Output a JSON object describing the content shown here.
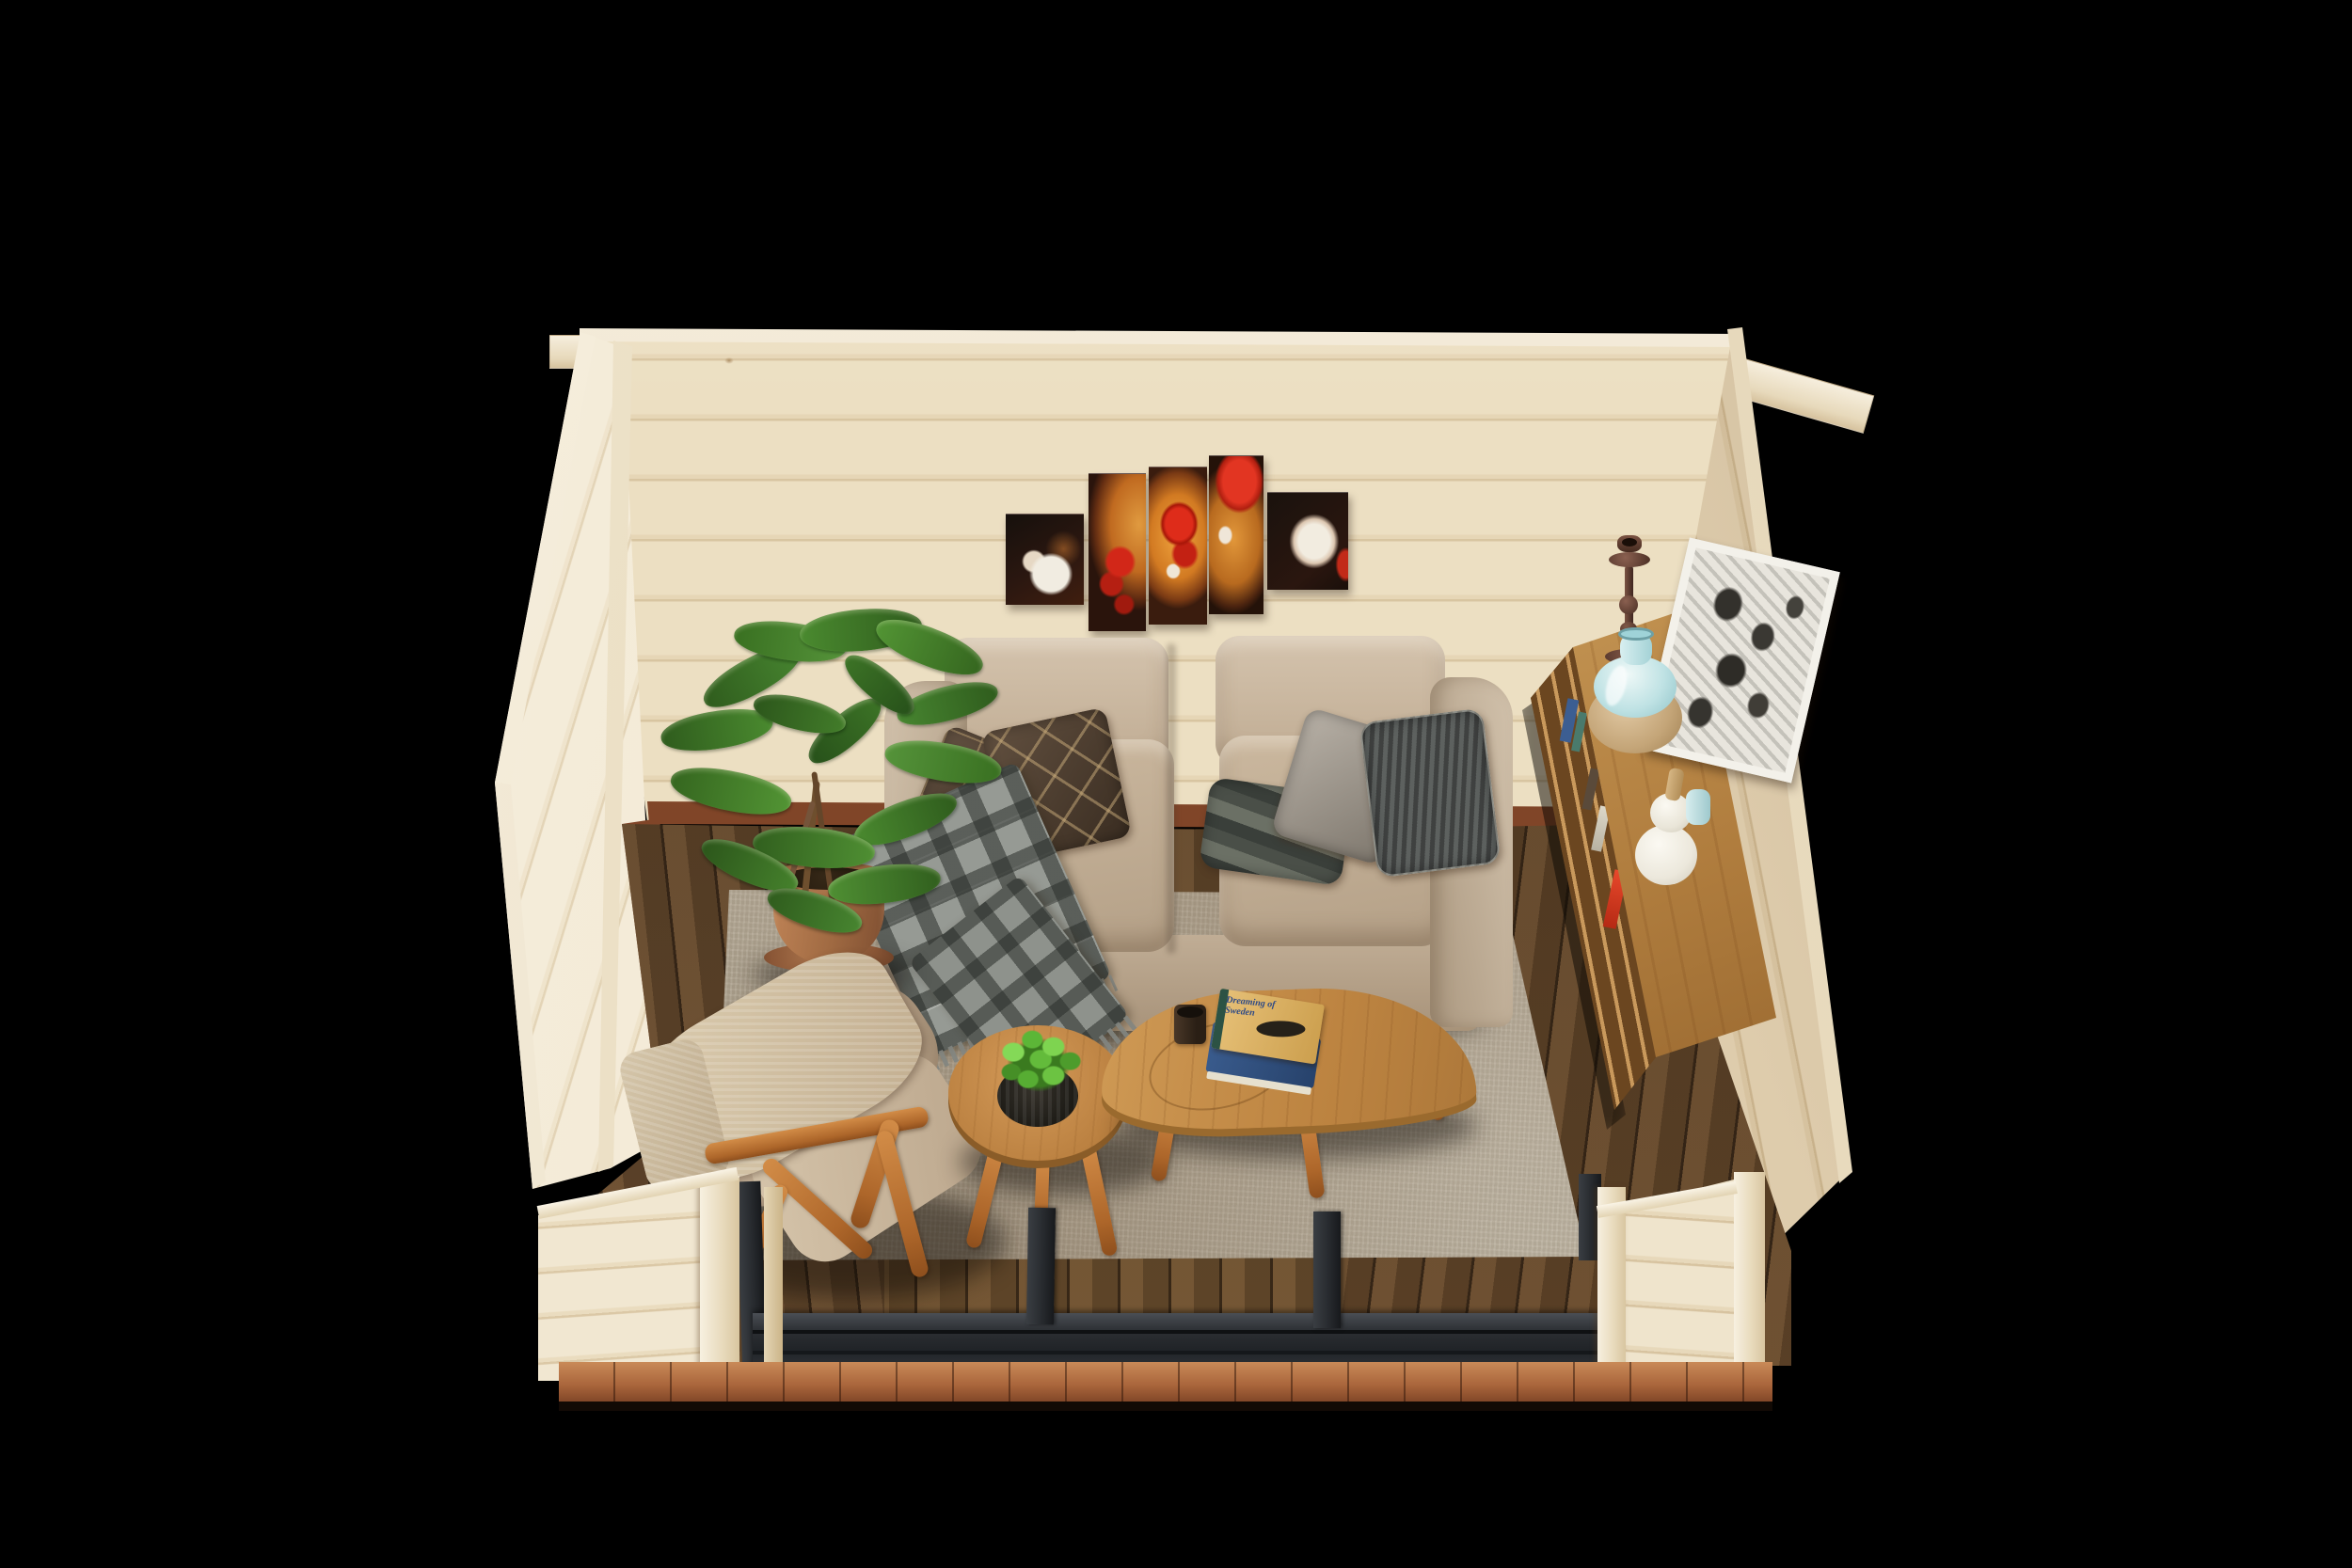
{
  "scene": {
    "description": "Isometric 3D render of a log-cabin garden-room interior: beige two-seat sofa with pillows under a five-panel magnolia canvas, potted ficus, beige armchair with throw, two oak nesting coffee tables with books and a candle, oak sideboard with vases and a framed print, distressed grey rug over a dark walnut deck floor, anthracite sliding-door track at the open front, black background",
    "background_color": "#000000"
  },
  "palette": {
    "bg": "#000000",
    "pine": "#e9dcbf",
    "pine_light": "#f4ecd9",
    "pine_dark": "#d8c5a2",
    "floor": "#5a4129",
    "skirting": "#8a4a2c",
    "rug": "#b1a794",
    "sofa": "#c6b49c",
    "sofa_dark": "#b3a089",
    "oak": "#c79252",
    "oak_dark": "#9a6a2e",
    "terracotta": "#a96e46",
    "leaf_green": "#3e7427",
    "art_orange": "#d98a2e",
    "art_red": "#c62818",
    "art_black": "#1c120c",
    "art_white": "#efe8dc",
    "vase_blue": "#bfe2e4",
    "vase_white": "#f2efe7",
    "bronze": "#5a3b30",
    "metal": "#2b2e32",
    "sill": "#a86542",
    "plaid_grey": "#969a94",
    "throw_beige": "#d5c6aa",
    "book_blue": "#30517f",
    "book_cover": "#ddb568"
  },
  "objects": {
    "back_wall": {
      "label": "Back wall - natural pine boards"
    },
    "left_wall": {
      "label": "Left wall - natural pine boards"
    },
    "right_wall": {
      "label": "Right wall - natural pine boards"
    },
    "beam_ends": {
      "label": "Interlocking log beam ends"
    },
    "floor": {
      "label": "Dark walnut deck floor"
    },
    "skirting": {
      "label": "Red-brown skirting board"
    },
    "rug": {
      "label": "Distressed beige-grey area rug"
    },
    "wall_art": {
      "label": "Five-panel red magnolia canvas art",
      "panel_count": 5,
      "panels": [
        {
          "label": "Small black panel with white magnolia"
        },
        {
          "label": "Tall amber panel with red blooms"
        },
        {
          "label": "Tall orange centre panel with red magnolia"
        },
        {
          "label": "Tall panel with large red bloom"
        },
        {
          "label": "Small black panel with white magnolia"
        }
      ]
    },
    "sofa": {
      "label": "Beige two-seater fabric sofa",
      "pillows": [
        {
          "label": "Dark brown pillow with window-pane stitching"
        },
        {
          "label": "Brown pillow with gold diamond pattern"
        },
        {
          "label": "Grey striped lumbar pillow"
        },
        {
          "label": "Light grey velvet pillow"
        },
        {
          "label": "Charcoal corduroy pillow"
        }
      ],
      "blanket": {
        "label": "Grey plaid blanket draped over left armrest"
      }
    },
    "floor_plant": {
      "label": "Ficus plant in terracotta pot on saucer"
    },
    "armchair": {
      "label": "Beige armchair with mid-century wooden frame",
      "throw": {
        "label": "Beige woven throw"
      }
    },
    "coffee_table_large": {
      "label": "Oak kidney-shaped coffee table",
      "candle": {
        "label": "Candle in dark glass holder"
      }
    },
    "coffee_table_small": {
      "label": "Round oak nesting table",
      "plant": {
        "label": "Boxwood greenery in black pot"
      }
    },
    "book": {
      "title": "Dreaming of Sweden",
      "label": "Stack of two hardcover books with fish cover art"
    },
    "sideboard": {
      "label": "Oak sideboard with open shelves",
      "items": [
        {
          "label": "Bronze candlestick"
        },
        {
          "label": "Blue ceramic vase with wooden base"
        },
        {
          "label": "White gourd vase with wooden stopper"
        },
        {
          "label": "Small blue bud vase"
        },
        {
          "label": "Framed black-and-white abstract print"
        },
        {
          "label": "Books and magazines on shelves"
        }
      ]
    },
    "door_frame": {
      "label": "Anthracite sliding-door frame and floor track"
    },
    "front_sill": {
      "label": "Timber threshold sill"
    }
  }
}
